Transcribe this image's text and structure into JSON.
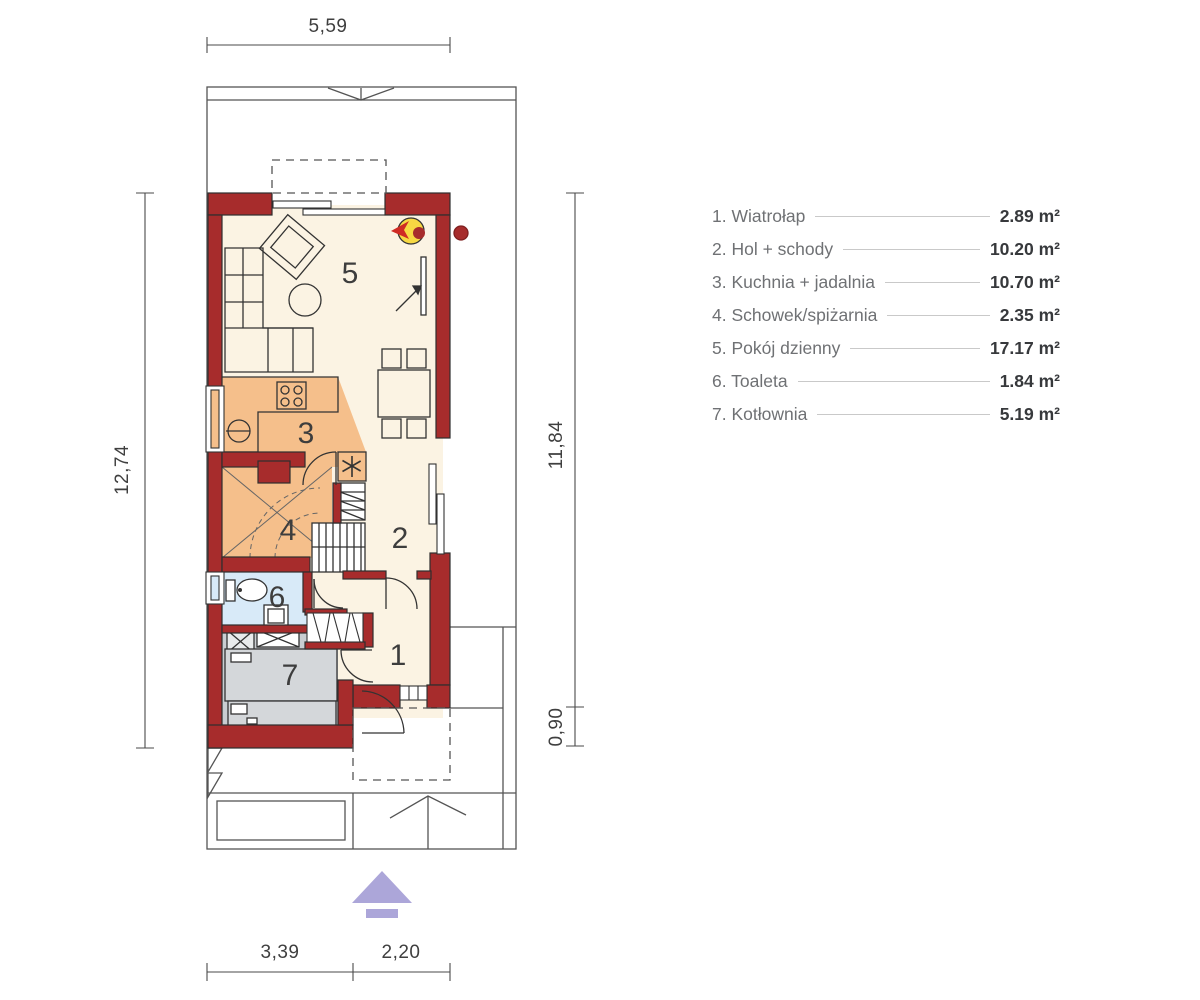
{
  "legend": {
    "items": [
      {
        "number": "1",
        "label": "1. Wiatrołap",
        "area": "2.89 m²"
      },
      {
        "number": "2",
        "label": "2. Hol + schody",
        "area": "10.20 m²"
      },
      {
        "number": "3",
        "label": "3. Kuchnia + jadalnia",
        "area": "10.70 m²"
      },
      {
        "number": "4",
        "label": "4. Schowek/spiżarnia",
        "area": "2.35 m²"
      },
      {
        "number": "5",
        "label": "5. Pokój dzienny",
        "area": "17.17 m²"
      },
      {
        "number": "6",
        "label": "6. Toaleta",
        "area": "1.84 m²"
      },
      {
        "number": "7",
        "label": "7. Kotłownia",
        "area": "5.19 m²"
      }
    ]
  },
  "dimensions": {
    "top": "5,59",
    "left": "12,74",
    "right_upper": "11,84",
    "right_lower": "0,90",
    "bottom_left": "3,39",
    "bottom_right": "2,20"
  },
  "colors": {
    "wall": "#a72c2c",
    "floor": "#fbf3e3",
    "kitchen": "#f5bf8b",
    "toilet": "#d8eaf8",
    "boiler_room": "#c9cdd1",
    "fireplace": "#f7d943",
    "entrance_arrow": "#aca6d9",
    "outline": "#333333"
  }
}
